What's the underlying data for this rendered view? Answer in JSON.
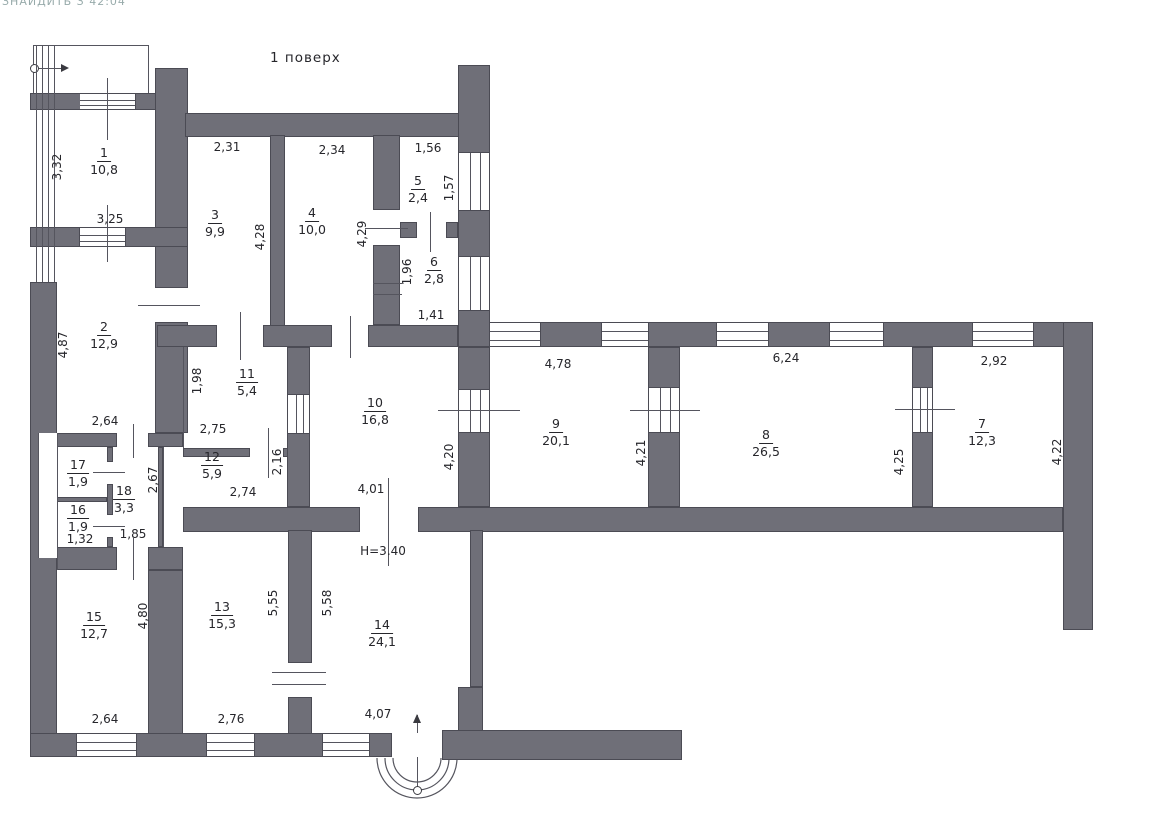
{
  "artifact_text": "ЗНАЙДИТЬ З 42:04",
  "title": "1 поверх",
  "colors": {
    "wall_fill": "#6f6f78",
    "wall_edge": "#4b4b54",
    "line": "#55555e",
    "text": "#26262b"
  },
  "rooms": [
    {
      "number": "1",
      "area": "10,8",
      "x": 104,
      "y": 146
    },
    {
      "number": "2",
      "area": "12,9",
      "x": 104,
      "y": 320
    },
    {
      "number": "3",
      "area": "9,9",
      "x": 215,
      "y": 208
    },
    {
      "number": "4",
      "area": "10,0",
      "x": 312,
      "y": 206
    },
    {
      "number": "5",
      "area": "2,4",
      "x": 418,
      "y": 174
    },
    {
      "number": "6",
      "area": "2,8",
      "x": 434,
      "y": 255
    },
    {
      "number": "7",
      "area": "12,3",
      "x": 982,
      "y": 417
    },
    {
      "number": "8",
      "area": "26,5",
      "x": 766,
      "y": 428
    },
    {
      "number": "9",
      "area": "20,1",
      "x": 556,
      "y": 417
    },
    {
      "number": "10",
      "area": "16,8",
      "x": 375,
      "y": 396
    },
    {
      "number": "11",
      "area": "5,4",
      "x": 247,
      "y": 367
    },
    {
      "number": "12",
      "area": "5,9",
      "x": 212,
      "y": 450
    },
    {
      "number": "13",
      "area": "15,3",
      "x": 222,
      "y": 600
    },
    {
      "number": "14",
      "area": "24,1",
      "x": 382,
      "y": 618
    },
    {
      "number": "15",
      "area": "12,7",
      "x": 94,
      "y": 610
    },
    {
      "number": "16",
      "area": "1,9",
      "x": 78,
      "y": 503
    },
    {
      "number": "17",
      "area": "1,9",
      "x": 78,
      "y": 458
    },
    {
      "number": "18",
      "area": "3,3",
      "x": 124,
      "y": 484
    }
  ],
  "dimensions_horizontal": [
    {
      "text": "3,25",
      "x": 110,
      "y": 219
    },
    {
      "text": "2,31",
      "x": 227,
      "y": 147
    },
    {
      "text": "2,34",
      "x": 332,
      "y": 150
    },
    {
      "text": "1,56",
      "x": 428,
      "y": 148
    },
    {
      "text": "1,41",
      "x": 431,
      "y": 315
    },
    {
      "text": "2,64",
      "x": 105,
      "y": 421
    },
    {
      "text": "2,75",
      "x": 213,
      "y": 429
    },
    {
      "text": "2,74",
      "x": 243,
      "y": 492
    },
    {
      "text": "1,32",
      "x": 80,
      "y": 539
    },
    {
      "text": "1,85",
      "x": 133,
      "y": 534
    },
    {
      "text": "4,78",
      "x": 558,
      "y": 364
    },
    {
      "text": "6,24",
      "x": 786,
      "y": 358
    },
    {
      "text": "2,92",
      "x": 994,
      "y": 361
    },
    {
      "text": "4,01",
      "x": 371,
      "y": 489
    },
    {
      "text": "H=3.40",
      "x": 383,
      "y": 551
    },
    {
      "text": "2,64",
      "x": 105,
      "y": 719
    },
    {
      "text": "2,76",
      "x": 231,
      "y": 719
    },
    {
      "text": "4,07",
      "x": 378,
      "y": 714
    }
  ],
  "dimensions_vertical": [
    {
      "text": "3,32",
      "x": 57,
      "y": 167
    },
    {
      "text": "4,87",
      "x": 63,
      "y": 345
    },
    {
      "text": "1,98",
      "x": 197,
      "y": 381
    },
    {
      "text": "4,28",
      "x": 260,
      "y": 237
    },
    {
      "text": "4,29",
      "x": 362,
      "y": 234
    },
    {
      "text": "1,57",
      "x": 449,
      "y": 188
    },
    {
      "text": "1,96",
      "x": 407,
      "y": 272
    },
    {
      "text": "2,67",
      "x": 153,
      "y": 480
    },
    {
      "text": "2,16",
      "x": 277,
      "y": 462
    },
    {
      "text": "4,20",
      "x": 449,
      "y": 457
    },
    {
      "text": "4,21",
      "x": 641,
      "y": 453
    },
    {
      "text": "4,25",
      "x": 899,
      "y": 462
    },
    {
      "text": "4,22",
      "x": 1057,
      "y": 452
    },
    {
      "text": "4,80",
      "x": 143,
      "y": 616
    },
    {
      "text": "5,55",
      "x": 273,
      "y": 603
    },
    {
      "text": "5,58",
      "x": 327,
      "y": 603
    }
  ]
}
